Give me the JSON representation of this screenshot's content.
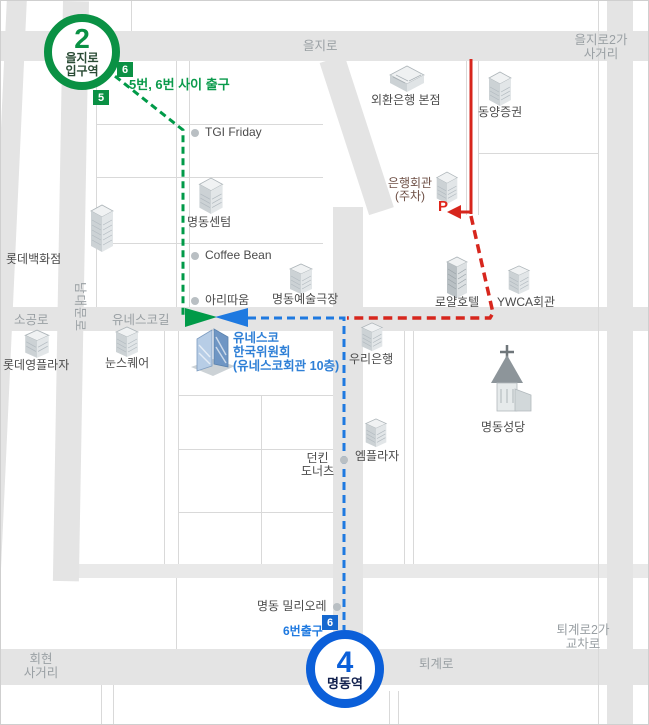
{
  "subway": {
    "line2": {
      "number": "2",
      "name_line1": "을지로",
      "name_line2": "입구역"
    },
    "line4": {
      "number": "4",
      "name": "명동역"
    }
  },
  "exits": {
    "badge6_top": "6",
    "badge5_top": "5",
    "note_top": "5번, 6번 사이 출구",
    "badge6_bottom": "6",
    "note_bottom": "6번출구"
  },
  "roads": {
    "euljiro": "을지로",
    "euljiro2ga_line1": "을지로2가",
    "euljiro2ga_line2": "사거리",
    "sogongro": "소공로",
    "namdaemunro": "남대문로",
    "unescogil": "유네스코길",
    "toegyero": "퇴계로",
    "toegyero2ga_line1": "퇴계로2가",
    "toegyero2ga_line2": "교차로",
    "hoehyeon_line1": "회현",
    "hoehyeon_line2": "사거리"
  },
  "pois": {
    "keb_bank": "외환은행 본점",
    "tongyang": "동양증권",
    "tgi": "TGI Friday",
    "centum": "명동센텀",
    "coffee_bean": "Coffee Bean",
    "aritaum": "아리따움",
    "theater": "명동예술극장",
    "lotte_dept": "롯데백화점",
    "lotte_young": "롯데영플라자",
    "noon_square": "눈스퀘어",
    "bank_hall_line1": "은행회관",
    "bank_hall_line2": "(주차)",
    "parking_mark": "P",
    "royal_hotel": "로얄호텔",
    "ywca": "YWCA회관",
    "woori_bank": "우리은행",
    "mplaza": "엠플라자",
    "dunkin_line1": "던킨",
    "dunkin_line2": "도너츠",
    "migliore": "명동 밀리오레",
    "cathedral": "명동성당",
    "unesco_line1": "유네스코",
    "unesco_line2": "한국위원회",
    "unesco_line3": "(유네스코회관 10층)"
  },
  "colors": {
    "route_green": "#009a48",
    "route_blue": "#1e79e0",
    "route_red": "#d7261d",
    "unesco_blue": "#2e7fd6"
  }
}
